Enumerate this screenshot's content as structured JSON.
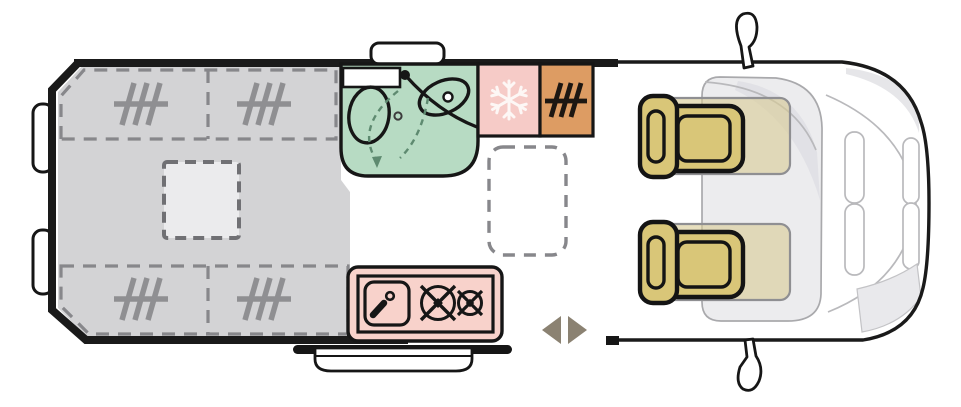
{
  "canvas": {
    "width": 961,
    "height": 407,
    "background": "#ffffff"
  },
  "palette": {
    "wall": "#1a1a1a",
    "outline": "#161616",
    "bed_gray": "#d3d3d5",
    "dash_gray": "#87878b",
    "hatch_gray": "#8f8f92",
    "skylight_fill": "#ebebed",
    "bath_green": "#b7dbc3",
    "bath_dash": "#5e8a70",
    "fridge_pink": "#f6cbc7",
    "kitchen_pink": "#f8d2cb",
    "heater_orange": "#dd9c63",
    "seat_tan": "#d9c678",
    "seat_ghost": "#d8cc96",
    "arrow_brown": "#8b8272",
    "cab_fill": "#ececee",
    "cab_shade": "#e0e0e4",
    "cab_line": "#b9b9bc",
    "white": "#ffffff",
    "snowflake": "#fdf7f5"
  },
  "zones": [
    "rear-double-bed",
    "skylight",
    "bathroom",
    "refrigerator",
    "heater-cabinet",
    "folding-table",
    "kitchen-block",
    "entry-step",
    "sliding-door",
    "driver-seat",
    "passenger-seat",
    "cab-front"
  ],
  "icons": [
    "bed-hatch-icon",
    "snowflake-icon",
    "heater-icon",
    "faucet-icon",
    "burner-icon",
    "toilet-icon",
    "washbasin-icon",
    "arrow-left-icon",
    "arrow-right-icon",
    "mirror-icon"
  ]
}
